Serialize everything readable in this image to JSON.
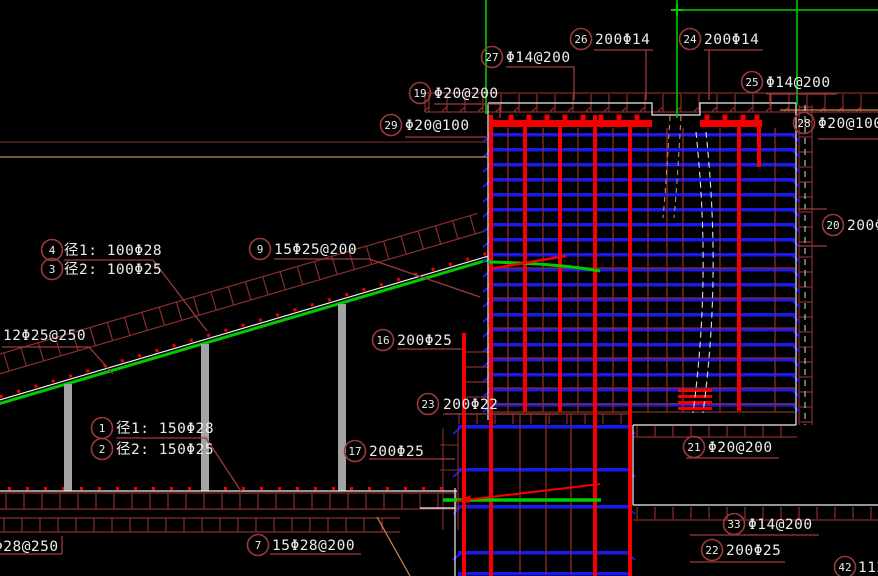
{
  "drawing": {
    "title": "reinforcement-section-detail",
    "background": "#000000",
    "colors": {
      "rebar_blue": "#1a1aee",
      "bar_red": "#f50000",
      "hatch_red": "#8a2e2e",
      "leader_red": "#9c3a3a",
      "dark_red_line": "#702525",
      "outline_white": "#f0f0f0",
      "rebar_green": "#00bb00",
      "tan": "#c98b4e",
      "column_gray": "#a3a3a3",
      "text": "#ededed"
    },
    "callouts": [
      {
        "id": "27",
        "text": "Φ14@200"
      },
      {
        "id": "26",
        "text": "200Φ14"
      },
      {
        "id": "24",
        "text": "200Φ14"
      },
      {
        "id": "25",
        "text": "Φ14@200"
      },
      {
        "id": "19",
        "text": "Φ20@200"
      },
      {
        "id": "29",
        "text": "Φ20@100"
      },
      {
        "id": "28",
        "text": "Φ20@100"
      },
      {
        "id": "20",
        "text": "200Φ"
      },
      {
        "id": "4",
        "text": "径1: 100Φ28"
      },
      {
        "id": "3",
        "text": "径2: 100Φ25"
      },
      {
        "id": "9",
        "text": "15Φ25@200"
      },
      {
        "id": "16",
        "text": "200Φ25"
      },
      {
        "id": "23",
        "text": "200Φ22"
      },
      {
        "id": "17",
        "text": "200Φ25"
      },
      {
        "id": "21",
        "text": "Φ20@200"
      },
      {
        "id": "1",
        "text": "径1: 150Φ28"
      },
      {
        "id": "2",
        "text": "径2: 150Φ25"
      },
      {
        "id": "7",
        "text": "15Φ28@200"
      },
      {
        "id": "33",
        "text": "Φ14@200"
      },
      {
        "id": "22",
        "text": "200Φ25"
      },
      {
        "id": "42",
        "text": "112"
      }
    ],
    "edge_labels": [
      {
        "text": "12Φ25@250"
      },
      {
        "text": "Φ28@250"
      }
    ]
  }
}
